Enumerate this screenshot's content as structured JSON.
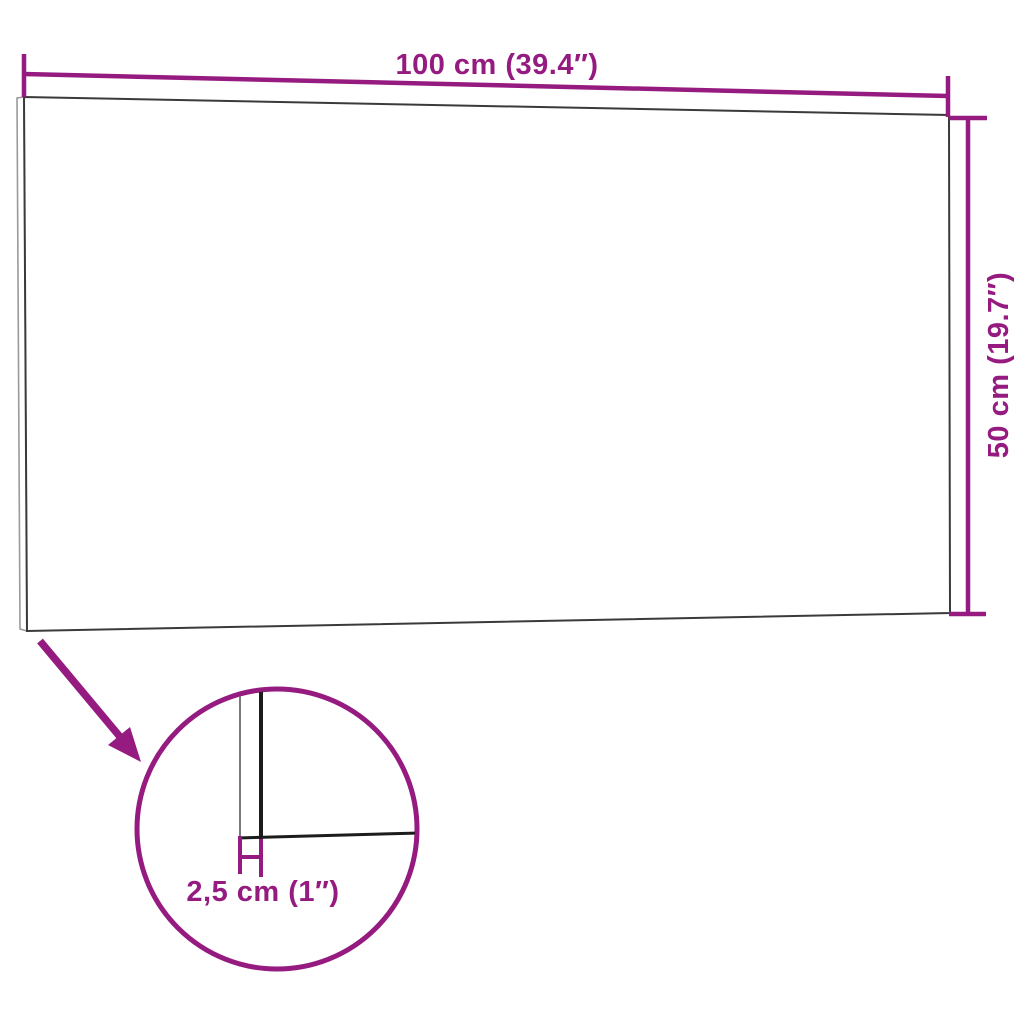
{
  "diagram": {
    "type": "product-dimension-diagram",
    "product": "wall-panel",
    "labels": {
      "width": "100 cm (39.4″)",
      "height": "50 cm (19.7″)",
      "thickness": "2,5 cm (1″)"
    },
    "values": {
      "width_cm": "100",
      "width_inch": "39.4",
      "height_cm": "50",
      "height_inch": "19.7",
      "thickness_cm": "2,5",
      "thickness_inch": "1"
    },
    "colors": {
      "accent": "#951B81",
      "panel_edge_dark": "#3A3A3A",
      "panel_edge_light": "#9A9A9A",
      "detail_edge_dark": "#1C1C1C",
      "detail_edge_light": "#7B7B7B",
      "background": "#FFFFFF"
    }
  }
}
